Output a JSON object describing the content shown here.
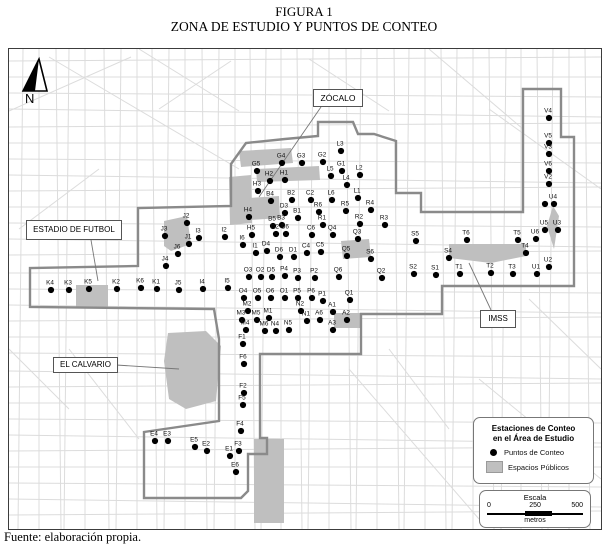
{
  "title": {
    "line1": "FIGURA 1",
    "line2": "ZONA DE ESTUDIO Y PUNTOS DE CONTEO"
  },
  "footer": {
    "source": "Fuente: elaboración propia."
  },
  "north": {
    "label": "N"
  },
  "colors": {
    "street": "#dcdcdc",
    "boundary": "#8a8a8a",
    "public_space": "#bfbfbf",
    "point": "#000000",
    "leader": "#777777"
  },
  "legend": {
    "title_line1": "Estaciones de Conteo",
    "title_line2": "en el Área de Estudio",
    "item_points": "Puntos de Conteo",
    "item_spaces": "Espacios Públicos"
  },
  "scale": {
    "title": "Escala",
    "tick0": "0",
    "tick250": "250",
    "tick500": "500",
    "unit": "metros"
  },
  "map": {
    "area_labels": [
      {
        "name": "zocalo",
        "text": "ZÓCALO",
        "leader": [
          312,
          58,
          250,
          148
        ]
      },
      {
        "name": "estadio",
        "text": "ESTADIO DE FUTBOL",
        "leader": [
          82,
          191,
          89,
          232
        ]
      },
      {
        "name": "calvario",
        "text": "EL CALVARIO",
        "leader": [
          107,
          316,
          170,
          320
        ]
      },
      {
        "name": "imss",
        "text": "IMSS",
        "leader": [
          482,
          261,
          460,
          214
        ]
      }
    ],
    "boundary": "M222,115 L237,94 L276,90 L309,87 L309,73 L344,73 L349,85 L365,85 L387,92 L387,144 L412,144 L412,163 L514,163 L514,40 L552,40 L552,88 L565,88 L565,237 L433,237 L433,265 L352,265 L352,305 L251,305 L251,389 L258,389 L258,405 L239,405 L239,442 L232,449 L135,449 L135,383 L210,372 L210,290 L205,260 L21,258 L21,219 L129,217 L129,159 L222,157 Z",
    "public_spaces": [
      {
        "name": "zocalo-strip-north",
        "points": "230,102 282,99 284,114 232,118"
      },
      {
        "name": "zocalo-strip-south",
        "points": "247,120 310,117 311,131 248,133"
      },
      {
        "name": "west-plaza",
        "points": "220,128 242,126 243,174 221,176"
      },
      {
        "name": "b4-block",
        "points": "240,149 270,147 271,169 241,171"
      },
      {
        "name": "estadio-block",
        "points": "155,172 178,167 182,195 162,202 155,197"
      },
      {
        "name": "k5-block",
        "points": "67,236 99,236 99,259 67,259"
      },
      {
        "name": "el-calvario",
        "points": "159,284 197,282 212,297 207,352 177,360 160,350 155,312"
      },
      {
        "name": "imss-block",
        "points": "440,195 517,195 517,207 482,214 440,209"
      },
      {
        "name": "q5-block",
        "points": "332,192 360,190 362,208 334,210"
      },
      {
        "name": "a-block",
        "points": "325,264 352,264 352,279 325,279"
      },
      {
        "name": "u-park",
        "points": "544,157 550,167 545,200 538,177"
      },
      {
        "name": "south-strip",
        "points": "245,390 275,390 275,474 245,474"
      }
    ],
    "points": [
      {
        "label": "K4",
        "x": 42,
        "y": 241
      },
      {
        "label": "K3",
        "x": 60,
        "y": 241
      },
      {
        "label": "K5",
        "x": 80,
        "y": 240
      },
      {
        "label": "K2",
        "x": 108,
        "y": 240
      },
      {
        "label": "K6",
        "x": 132,
        "y": 239
      },
      {
        "label": "K1",
        "x": 148,
        "y": 240
      },
      {
        "label": "J2",
        "x": 178,
        "y": 174
      },
      {
        "label": "J3",
        "x": 156,
        "y": 187
      },
      {
        "label": "J1",
        "x": 180,
        "y": 195
      },
      {
        "label": "J6",
        "x": 169,
        "y": 205
      },
      {
        "label": "J4",
        "x": 157,
        "y": 217
      },
      {
        "label": "J5",
        "x": 170,
        "y": 241
      },
      {
        "label": "I2",
        "x": 216,
        "y": 188
      },
      {
        "label": "I3",
        "x": 190,
        "y": 189
      },
      {
        "label": "I6",
        "x": 234,
        "y": 196
      },
      {
        "label": "I1",
        "x": 247,
        "y": 204
      },
      {
        "label": "I4",
        "x": 194,
        "y": 240
      },
      {
        "label": "I5",
        "x": 219,
        "y": 239
      },
      {
        "label": "G5",
        "x": 248,
        "y": 122
      },
      {
        "label": "G4",
        "x": 273,
        "y": 114
      },
      {
        "label": "G3",
        "x": 293,
        "y": 114
      },
      {
        "label": "G2",
        "x": 314,
        "y": 113
      },
      {
        "label": "G1",
        "x": 333,
        "y": 122
      },
      {
        "label": "H2",
        "x": 261,
        "y": 132
      },
      {
        "label": "H1",
        "x": 276,
        "y": 131
      },
      {
        "label": "H3",
        "x": 249,
        "y": 142
      },
      {
        "label": "H4",
        "x": 240,
        "y": 168
      },
      {
        "label": "H5",
        "x": 243,
        "y": 186
      },
      {
        "label": "B4",
        "x": 262,
        "y": 152
      },
      {
        "label": "B2",
        "x": 283,
        "y": 151
      },
      {
        "label": "B1",
        "x": 289,
        "y": 169
      },
      {
        "label": "B5",
        "x": 264,
        "y": 177
      },
      {
        "label": "B3",
        "x": 273,
        "y": 176
      },
      {
        "label": "B6",
        "x": 277,
        "y": 185
      },
      {
        "label": "D2",
        "x": 267,
        "y": 185
      },
      {
        "label": "D3",
        "x": 276,
        "y": 164
      },
      {
        "label": "D4",
        "x": 258,
        "y": 202
      },
      {
        "label": "D6",
        "x": 271,
        "y": 208
      },
      {
        "label": "D1",
        "x": 285,
        "y": 208
      },
      {
        "label": "D5",
        "x": 263,
        "y": 228
      },
      {
        "label": "C2",
        "x": 302,
        "y": 151
      },
      {
        "label": "C6",
        "x": 303,
        "y": 186
      },
      {
        "label": "C4",
        "x": 298,
        "y": 204
      },
      {
        "label": "C5",
        "x": 312,
        "y": 203
      },
      {
        "label": "L3",
        "x": 332,
        "y": 102
      },
      {
        "label": "L5",
        "x": 322,
        "y": 127
      },
      {
        "label": "L2",
        "x": 351,
        "y": 126
      },
      {
        "label": "L4",
        "x": 338,
        "y": 136
      },
      {
        "label": "L6",
        "x": 323,
        "y": 151
      },
      {
        "label": "L1",
        "x": 349,
        "y": 149
      },
      {
        "label": "R6",
        "x": 310,
        "y": 163
      },
      {
        "label": "R5",
        "x": 337,
        "y": 162
      },
      {
        "label": "R4",
        "x": 362,
        "y": 161
      },
      {
        "label": "R1",
        "x": 314,
        "y": 176
      },
      {
        "label": "R2",
        "x": 351,
        "y": 175
      },
      {
        "label": "R3",
        "x": 376,
        "y": 176
      },
      {
        "label": "Q4",
        "x": 324,
        "y": 186
      },
      {
        "label": "Q3",
        "x": 349,
        "y": 190
      },
      {
        "label": "Q5",
        "x": 338,
        "y": 207
      },
      {
        "label": "Q6",
        "x": 330,
        "y": 228
      },
      {
        "label": "Q2",
        "x": 373,
        "y": 229
      },
      {
        "label": "Q1",
        "x": 341,
        "y": 251
      },
      {
        "label": "O3",
        "x": 240,
        "y": 228
      },
      {
        "label": "O2",
        "x": 252,
        "y": 228
      },
      {
        "label": "P4",
        "x": 276,
        "y": 227
      },
      {
        "label": "P3",
        "x": 289,
        "y": 229
      },
      {
        "label": "P2",
        "x": 306,
        "y": 229
      },
      {
        "label": "O4",
        "x": 235,
        "y": 249
      },
      {
        "label": "O5",
        "x": 249,
        "y": 249
      },
      {
        "label": "O6",
        "x": 262,
        "y": 249
      },
      {
        "label": "O1",
        "x": 276,
        "y": 249
      },
      {
        "label": "P5",
        "x": 289,
        "y": 249
      },
      {
        "label": "P6",
        "x": 303,
        "y": 249
      },
      {
        "label": "P1",
        "x": 314,
        "y": 252
      },
      {
        "label": "S6",
        "x": 362,
        "y": 210
      },
      {
        "label": "S5",
        "x": 407,
        "y": 192
      },
      {
        "label": "S4",
        "x": 440,
        "y": 209
      },
      {
        "label": "S2",
        "x": 405,
        "y": 225
      },
      {
        "label": "S1",
        "x": 427,
        "y": 226
      },
      {
        "label": "M2",
        "x": 239,
        "y": 262
      },
      {
        "label": "M3",
        "x": 233,
        "y": 271
      },
      {
        "label": "M5",
        "x": 248,
        "y": 271
      },
      {
        "label": "M1",
        "x": 260,
        "y": 269
      },
      {
        "label": "M4",
        "x": 237,
        "y": 281
      },
      {
        "label": "M6",
        "x": 256,
        "y": 282
      },
      {
        "label": "N4",
        "x": 267,
        "y": 282
      },
      {
        "label": "N5",
        "x": 280,
        "y": 281
      },
      {
        "label": "N2",
        "x": 292,
        "y": 262
      },
      {
        "label": "N1",
        "x": 298,
        "y": 272
      },
      {
        "label": "A6",
        "x": 311,
        "y": 271
      },
      {
        "label": "A1",
        "x": 324,
        "y": 263
      },
      {
        "label": "A2",
        "x": 338,
        "y": 271
      },
      {
        "label": "A3",
        "x": 324,
        "y": 281
      },
      {
        "label": "F1",
        "x": 234,
        "y": 295
      },
      {
        "label": "F6",
        "x": 235,
        "y": 315
      },
      {
        "label": "F2",
        "x": 235,
        "y": 344
      },
      {
        "label": "F5",
        "x": 234,
        "y": 356
      },
      {
        "label": "F4",
        "x": 232,
        "y": 382
      },
      {
        "label": "F3",
        "x": 230,
        "y": 402
      },
      {
        "label": "E4",
        "x": 146,
        "y": 392
      },
      {
        "label": "E3",
        "x": 159,
        "y": 392
      },
      {
        "label": "E5",
        "x": 186,
        "y": 398
      },
      {
        "label": "E2",
        "x": 198,
        "y": 402
      },
      {
        "label": "E1",
        "x": 221,
        "y": 407
      },
      {
        "label": "E6",
        "x": 227,
        "y": 423
      },
      {
        "label": "T6",
        "x": 458,
        "y": 191
      },
      {
        "label": "T5",
        "x": 509,
        "y": 191
      },
      {
        "label": "T4",
        "x": 517,
        "y": 204
      },
      {
        "label": "T1",
        "x": 451,
        "y": 225
      },
      {
        "label": "T2",
        "x": 482,
        "y": 224
      },
      {
        "label": "T3",
        "x": 504,
        "y": 225
      },
      {
        "label": "U6",
        "x": 527,
        "y": 190
      },
      {
        "label": "U5",
        "x": 536,
        "y": 181
      },
      {
        "label": "U3",
        "x": 549,
        "y": 181
      },
      {
        "label": "U4",
        "x": 545,
        "y": 155
      },
      {
        "label": "",
        "x": 536,
        "y": 155
      },
      {
        "label": "U2",
        "x": 540,
        "y": 218
      },
      {
        "label": "U1",
        "x": 528,
        "y": 225
      },
      {
        "label": "V4",
        "x": 540,
        "y": 69
      },
      {
        "label": "V5",
        "x": 540,
        "y": 94
      },
      {
        "label": "V3",
        "x": 540,
        "y": 105
      },
      {
        "label": "V6",
        "x": 540,
        "y": 122
      },
      {
        "label": "V2",
        "x": 540,
        "y": 135
      }
    ]
  }
}
